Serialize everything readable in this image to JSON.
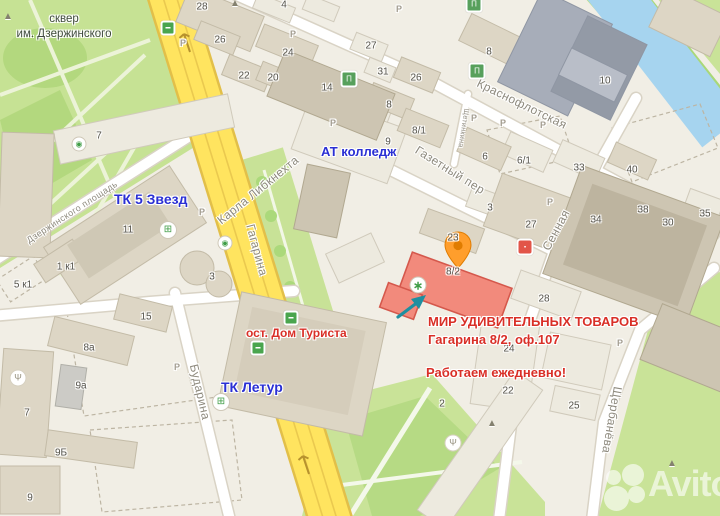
{
  "park": {
    "line1": "сквер",
    "line2": "им. Дзержинского"
  },
  "annotations": {
    "mall_5stars": "ТК 5 Звезд",
    "college": "АТ колледж",
    "mall_letur": "ТК Летур",
    "stop_label": "ост. Дом Туриста",
    "store_title": "МИР УДИВИТЕЛЬНЫХ ТОВАРОВ",
    "store_address": "Гагарина 8/2, оф.107",
    "store_hours": "Работаем ежедневно!"
  },
  "map_labels": {
    "parking_letter": "P",
    "highlighted_building": "8/2"
  },
  "streets": [
    {
      "name": "Карла Либкнехта",
      "x": 258,
      "y": 190,
      "rot": -39,
      "size": 12
    },
    {
      "name": "Гагарина",
      "x": 257,
      "y": 250,
      "rot": 75,
      "size": 12
    },
    {
      "name": "Газетный пер",
      "x": 450,
      "y": 170,
      "rot": 32,
      "size": 12
    },
    {
      "name": "Краснофлотская",
      "x": 522,
      "y": 104,
      "rot": 26,
      "size": 12
    },
    {
      "name": "Сенная",
      "x": 556,
      "y": 230,
      "rot": -62,
      "size": 12
    },
    {
      "name": "Щербанёва",
      "x": 612,
      "y": 420,
      "rot": 100,
      "size": 12
    },
    {
      "name": "Бударина",
      "x": 200,
      "y": 392,
      "rot": 77,
      "size": 12
    },
    {
      "name": "Дзержинского площадь",
      "x": 72,
      "y": 212,
      "rot": -33,
      "size": 9
    },
    {
      "name": "Щетинкина",
      "x": 463,
      "y": 128,
      "rot": 99,
      "size": 7
    }
  ],
  "building_numbers": [
    {
      "t": "28",
      "x": 202,
      "y": 7
    },
    {
      "t": "26",
      "x": 220,
      "y": 40
    },
    {
      "t": "4",
      "x": 284,
      "y": 5
    },
    {
      "t": "24",
      "x": 288,
      "y": 53
    },
    {
      "t": "22",
      "x": 244,
      "y": 76
    },
    {
      "t": "20",
      "x": 273,
      "y": 78
    },
    {
      "t": "14",
      "x": 327,
      "y": 88
    },
    {
      "t": "27",
      "x": 371,
      "y": 46
    },
    {
      "t": "31",
      "x": 383,
      "y": 72
    },
    {
      "t": "26",
      "x": 416,
      "y": 78
    },
    {
      "t": "8",
      "x": 389,
      "y": 105
    },
    {
      "t": "8/1",
      "x": 419,
      "y": 131
    },
    {
      "t": "9",
      "x": 388,
      "y": 142
    },
    {
      "t": "7",
      "x": 99,
      "y": 136
    },
    {
      "t": "8",
      "x": 489,
      "y": 52
    },
    {
      "t": "10",
      "x": 605,
      "y": 81
    },
    {
      "t": "6",
      "x": 485,
      "y": 157
    },
    {
      "t": "6/1",
      "x": 524,
      "y": 161
    },
    {
      "t": "33",
      "x": 579,
      "y": 168
    },
    {
      "t": "40",
      "x": 632,
      "y": 170
    },
    {
      "t": "3",
      "x": 490,
      "y": 208
    },
    {
      "t": "23",
      "x": 453,
      "y": 238
    },
    {
      "t": "27",
      "x": 531,
      "y": 225
    },
    {
      "t": "34",
      "x": 596,
      "y": 220
    },
    {
      "t": "38",
      "x": 643,
      "y": 210
    },
    {
      "t": "30",
      "x": 668,
      "y": 223
    },
    {
      "t": "35",
      "x": 705,
      "y": 214
    },
    {
      "t": "8/2",
      "x": 453,
      "y": 272
    },
    {
      "t": "28",
      "x": 544,
      "y": 299
    },
    {
      "t": "24",
      "x": 509,
      "y": 349
    },
    {
      "t": "22",
      "x": 508,
      "y": 391
    },
    {
      "t": "2",
      "x": 442,
      "y": 404
    },
    {
      "t": "25",
      "x": 574,
      "y": 406
    },
    {
      "t": "11",
      "x": 128,
      "y": 230
    },
    {
      "t": "1 к1",
      "x": 66,
      "y": 267
    },
    {
      "t": "5 к1",
      "x": 23,
      "y": 285
    },
    {
      "t": "3",
      "x": 212,
      "y": 277
    },
    {
      "t": "15",
      "x": 146,
      "y": 317
    },
    {
      "t": "8а",
      "x": 89,
      "y": 348
    },
    {
      "t": "9а",
      "x": 81,
      "y": 386
    },
    {
      "t": "7",
      "x": 27,
      "y": 413
    },
    {
      "t": "9Б",
      "x": 61,
      "y": 453
    },
    {
      "t": "9",
      "x": 30,
      "y": 498
    }
  ],
  "parkings": [
    {
      "x": 183,
      "y": 43
    },
    {
      "x": 293,
      "y": 34
    },
    {
      "x": 399,
      "y": 9
    },
    {
      "x": 333,
      "y": 123
    },
    {
      "x": 474,
      "y": 118
    },
    {
      "x": 503,
      "y": 123
    },
    {
      "x": 543,
      "y": 125
    },
    {
      "x": 550,
      "y": 202
    },
    {
      "x": 202,
      "y": 212
    },
    {
      "x": 177,
      "y": 367
    },
    {
      "x": 620,
      "y": 343
    }
  ],
  "pois": [
    {
      "t": "monument",
      "g": "▲",
      "x": 235,
      "y": 4
    },
    {
      "t": "monument",
      "g": "▲",
      "x": 8,
      "y": 17
    },
    {
      "t": "monument",
      "g": "▲",
      "x": 492,
      "y": 424
    },
    {
      "t": "monument",
      "g": "▲",
      "x": 672,
      "y": 464
    },
    {
      "t": "restaurant",
      "g": "Ψ",
      "x": 18,
      "y": 378
    },
    {
      "t": "restaurant",
      "g": "Ψ",
      "x": 453,
      "y": 443
    },
    {
      "t": "library",
      "g": "Π",
      "x": 474,
      "y": 4
    },
    {
      "t": "library",
      "g": "Π",
      "x": 477,
      "y": 71
    },
    {
      "t": "library",
      "g": "Π",
      "x": 349,
      "y": 79
    },
    {
      "t": "bus-stop",
      "g": "▬",
      "x": 168,
      "y": 28
    },
    {
      "t": "bus-stop",
      "g": "▬",
      "x": 291,
      "y": 318
    },
    {
      "t": "bus-stop",
      "g": "▬",
      "x": 258,
      "y": 348
    },
    {
      "t": "cart",
      "g": "⊞",
      "x": 168,
      "y": 230
    },
    {
      "t": "cart",
      "g": "⊞",
      "x": 221,
      "y": 402
    },
    {
      "t": "transit",
      "g": "◉",
      "x": 225,
      "y": 243
    },
    {
      "t": "transit",
      "g": "◉",
      "x": 79,
      "y": 144
    },
    {
      "t": "laundry",
      "g": "∗",
      "x": 418,
      "y": 285
    },
    {
      "t": "shop",
      "g": "▪",
      "x": 525,
      "y": 247
    }
  ],
  "watermark": {
    "text": "Avito"
  },
  "colors": {
    "highlight_fill": "#f28a7c",
    "highlight_stroke": "#d5584c",
    "annotation_red": "#d92f27",
    "annotation_blue": "#2a2fd4",
    "road_yellow": "#ffe45f",
    "park_green": "#c6e294",
    "water_blue": "#a6d4ef",
    "pin_orange": "#ff9e2c"
  }
}
